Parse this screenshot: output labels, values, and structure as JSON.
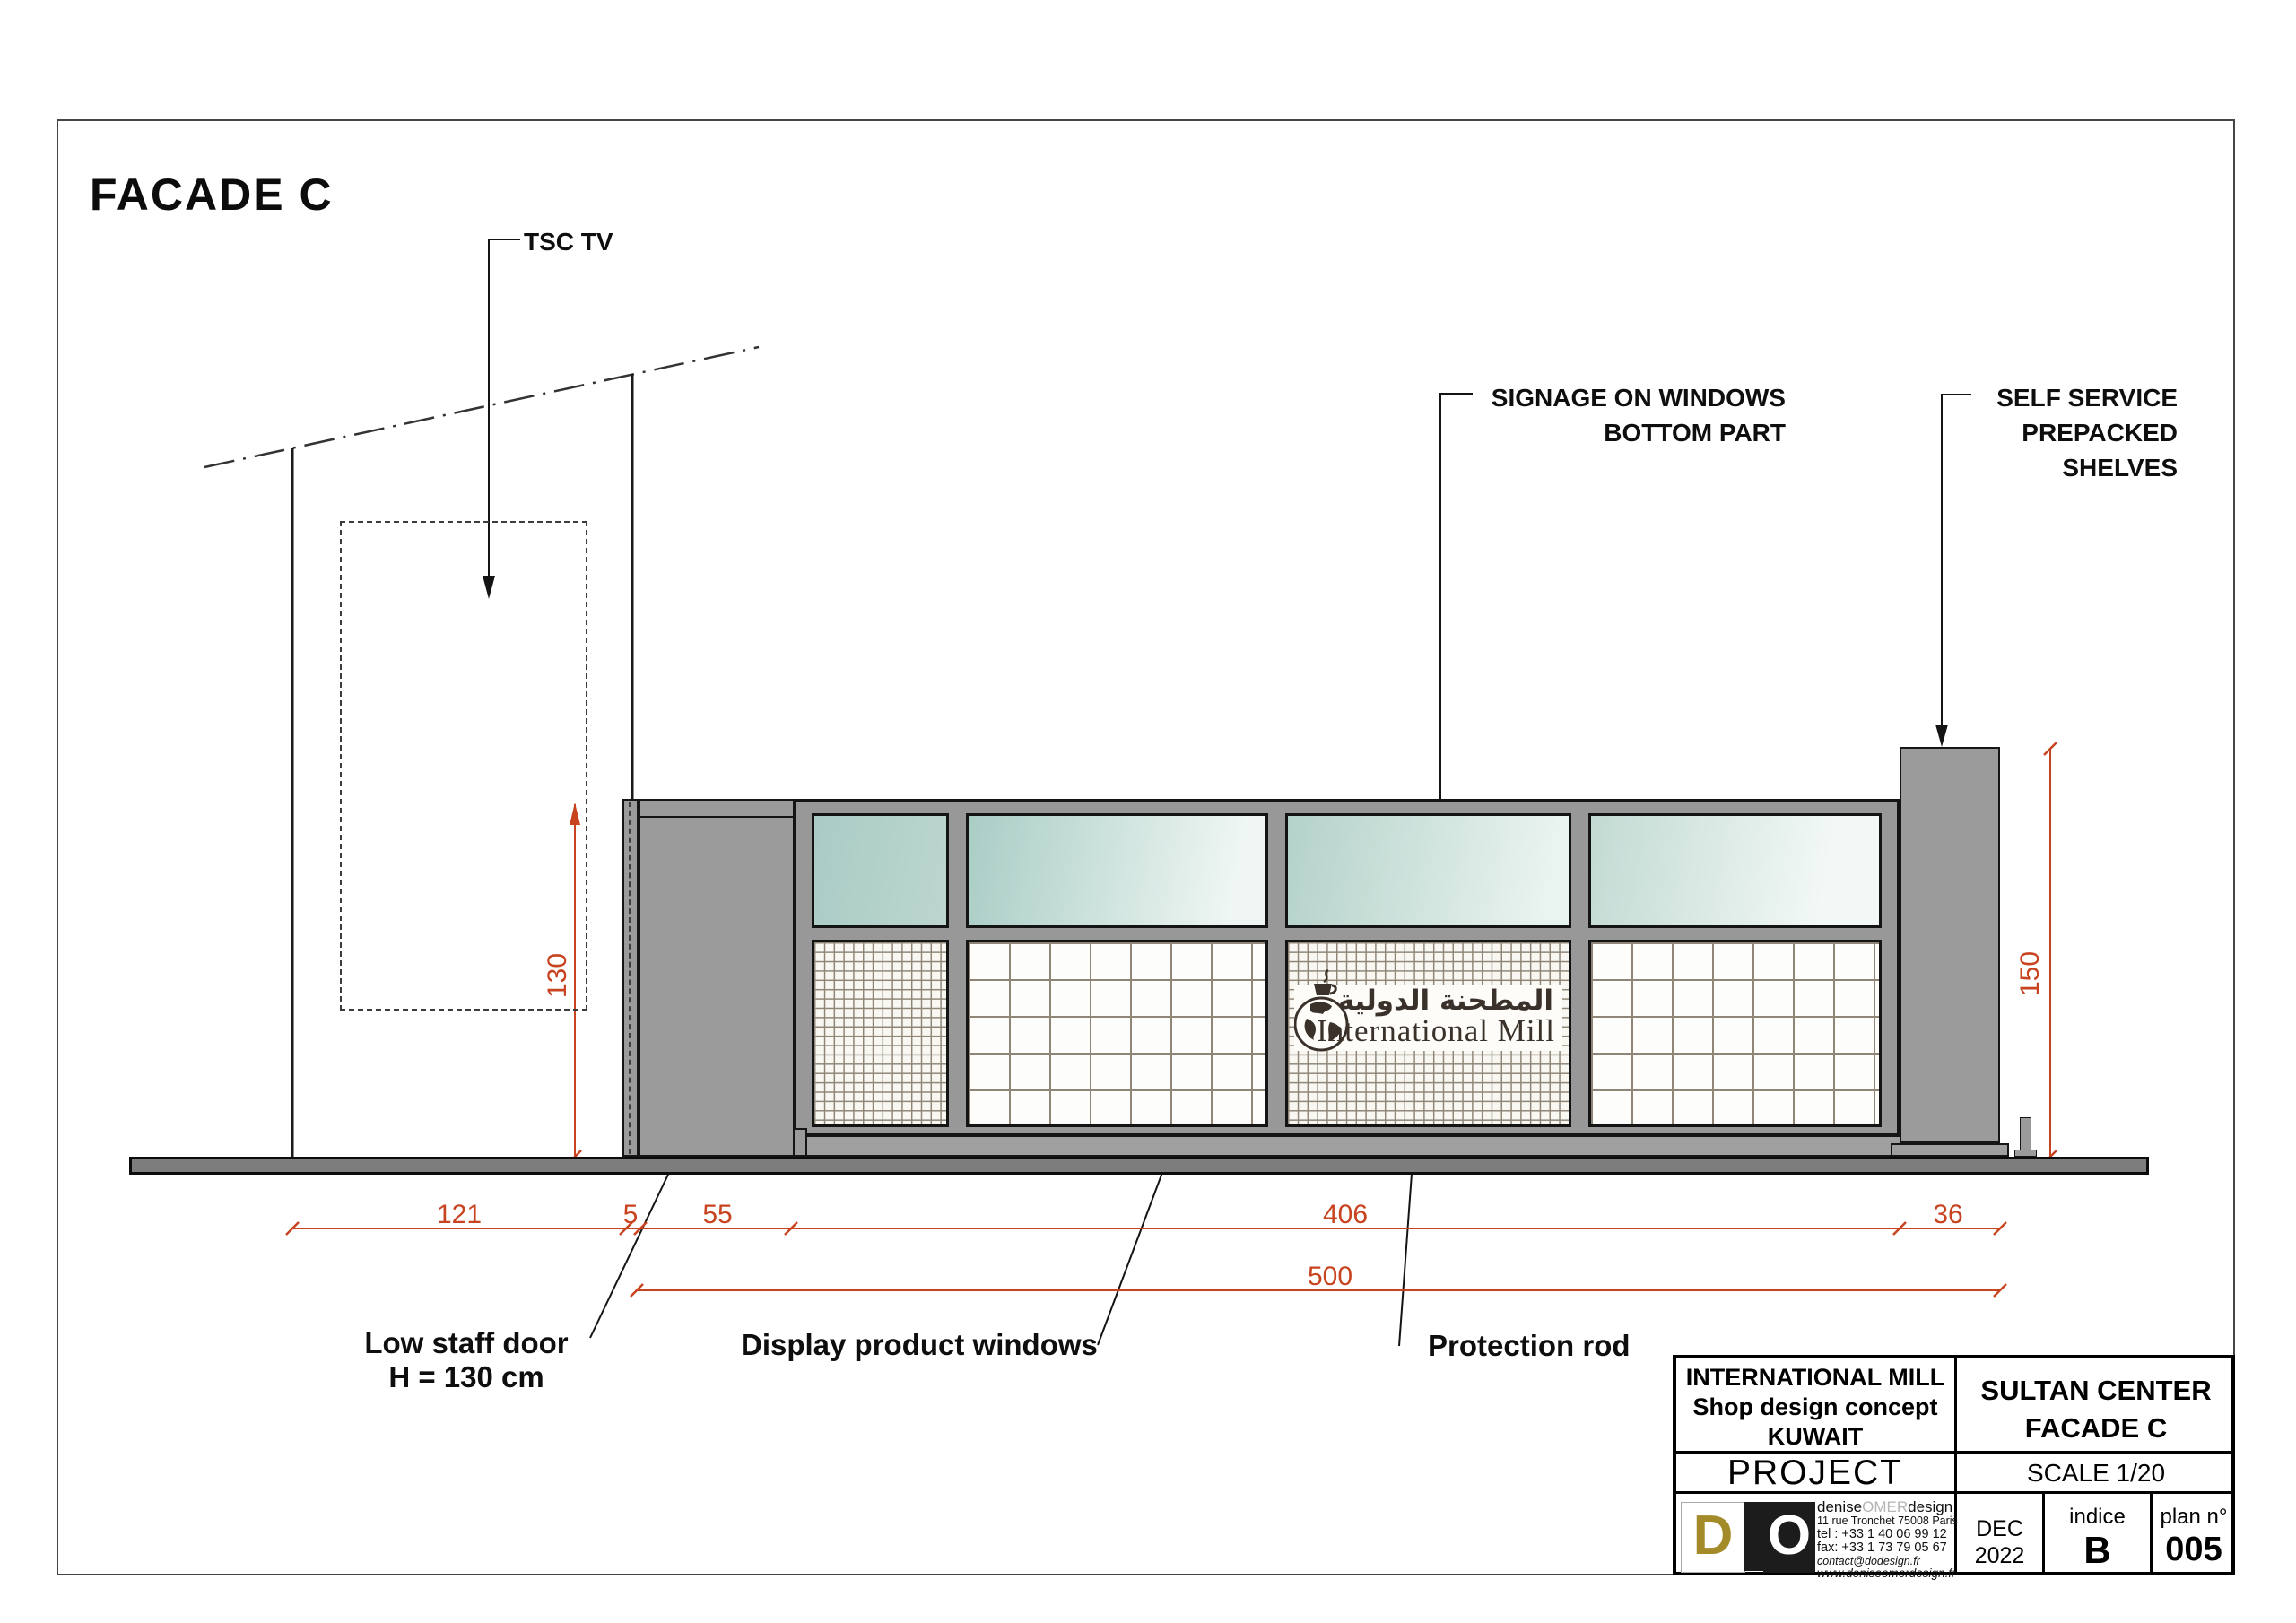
{
  "title": "FACADE C",
  "labels": {
    "tsc_tv": "TSC TV",
    "signage": [
      "SIGNAGE ON WINDOWS",
      "BOTTOM PART"
    ],
    "shelves": [
      "SELF SERVICE",
      "PREPACKED",
      "SHELVES"
    ],
    "low_door": [
      "Low staff door",
      "H = 130 cm"
    ],
    "display_windows": "Display product windows",
    "protection_rod": "Protection rod"
  },
  "dims": {
    "w121": "121",
    "w5": "5",
    "w55": "55",
    "w406": "406",
    "w36": "36",
    "w500": "500",
    "h130": "130",
    "h150": "150"
  },
  "shop_logo": {
    "arabic": "المطحنة الدولية",
    "latin": "International Mill"
  },
  "title_block": {
    "client": [
      "INTERNATIONAL MILL",
      "Shop design concept",
      "KUWAIT"
    ],
    "sheet": [
      "SULTAN CENTER",
      "FACADE C"
    ],
    "project_label": "PROJECT",
    "scale": "SCALE 1/20",
    "designer": {
      "logo_d": "D",
      "logo_o": "O",
      "strip_text": "denise omer design",
      "name_parts": [
        "denise",
        "OMER",
        "design"
      ],
      "address": "11 rue Tronchet 75008 Paris",
      "tel": "tel : +33 1 40 06 99 12",
      "fax": "fax: +33 1 73 79 05 67",
      "email": "contact@dodesign.fr",
      "web": "www.deniseomerdesign.fr"
    },
    "date": [
      "DEC",
      "2022"
    ],
    "indice_label": "indice",
    "indice_value": "B",
    "plan_label": "plan n°",
    "plan_value": "005"
  },
  "colors": {
    "dimension_red": "#c8431f",
    "glass_teal": "#aecfc8",
    "facade_grey": "#9b9b9b",
    "logo_olive": "#a38b2a"
  }
}
